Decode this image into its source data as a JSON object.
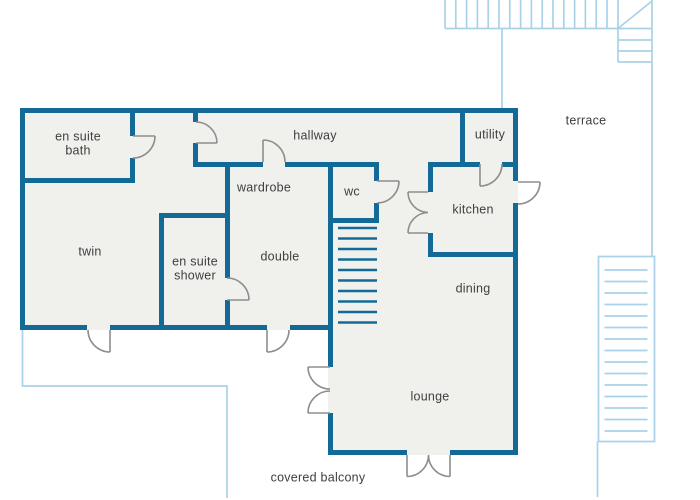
{
  "colors": {
    "wall": "#136a96",
    "floor": "#f0f1ed",
    "accent": "#a9d2e8",
    "door": "#8e8e8e",
    "text": "#3d4040",
    "background": "#ffffff"
  },
  "rooms": [
    {
      "name": "en-suite-bath",
      "label": "en suite\nbath"
    },
    {
      "name": "hallway",
      "label": "hallway"
    },
    {
      "name": "utility",
      "label": "utility"
    },
    {
      "name": "terrace",
      "label": "terrace"
    },
    {
      "name": "wardrobe",
      "label": "wardrobe"
    },
    {
      "name": "wc",
      "label": "wc"
    },
    {
      "name": "kitchen",
      "label": "kitchen"
    },
    {
      "name": "twin",
      "label": "twin"
    },
    {
      "name": "en-suite-shower",
      "label": "en suite\nshower"
    },
    {
      "name": "double",
      "label": "double"
    },
    {
      "name": "dining",
      "label": "dining"
    },
    {
      "name": "lounge",
      "label": "lounge"
    },
    {
      "name": "covered-balcony",
      "label": "covered balcony"
    }
  ]
}
